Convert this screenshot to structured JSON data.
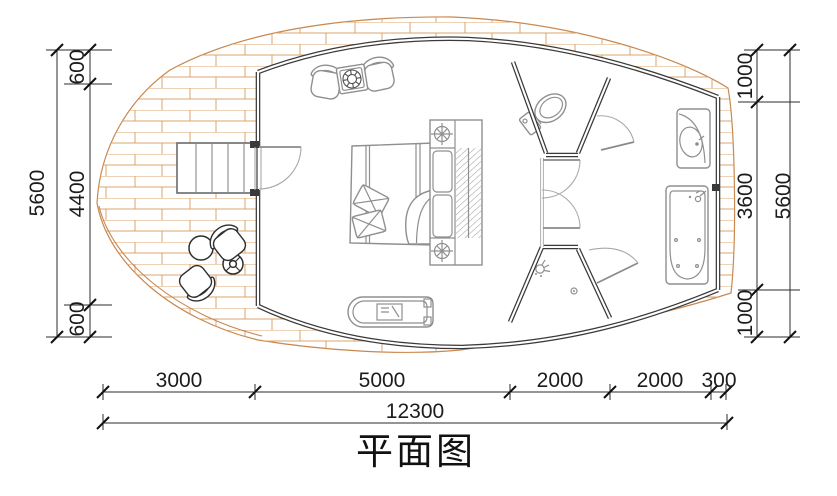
{
  "title": "平面图",
  "dims": {
    "left": {
      "segments": [
        "600",
        "4400",
        "600"
      ],
      "total": "5600"
    },
    "right": {
      "segments": [
        "1000",
        "3600",
        "1000"
      ],
      "total": "5600"
    },
    "bottom": {
      "segments": [
        "3000",
        "5000",
        "2000",
        "2000",
        "300"
      ],
      "total": "12300"
    }
  },
  "colors": {
    "deck_plank": "#d79a64",
    "wall": "#3a3a3a",
    "fixture_line": "#8f8f8f",
    "dimension_text": "#1c1c1c"
  }
}
